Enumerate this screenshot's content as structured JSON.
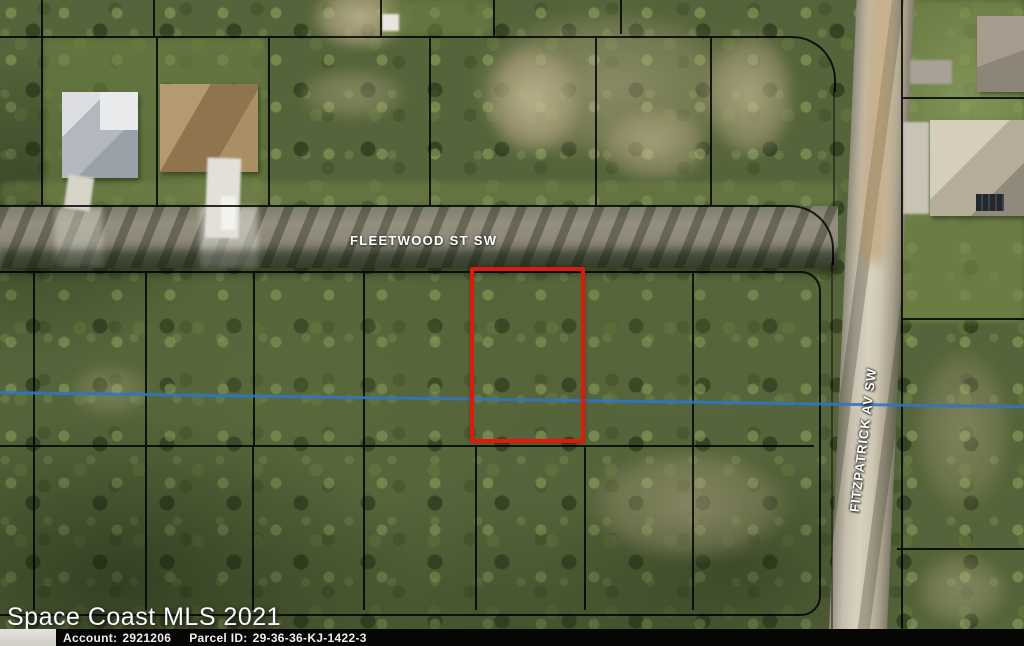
{
  "map": {
    "street_labels": {
      "horizontal": "FLEETWOOD ST SW",
      "vertical": "FITZPATRICK AV SW"
    },
    "watermark": "Space Coast MLS 2021",
    "parcel_highlight_color": "#de1a0a",
    "water_line_color": "#2e74c8"
  },
  "info_bar": {
    "account_label": "Account:",
    "account_value": "2921206",
    "parcel_id_label": "Parcel ID:",
    "parcel_id_value": "29-36-36-KJ-1422-3"
  }
}
